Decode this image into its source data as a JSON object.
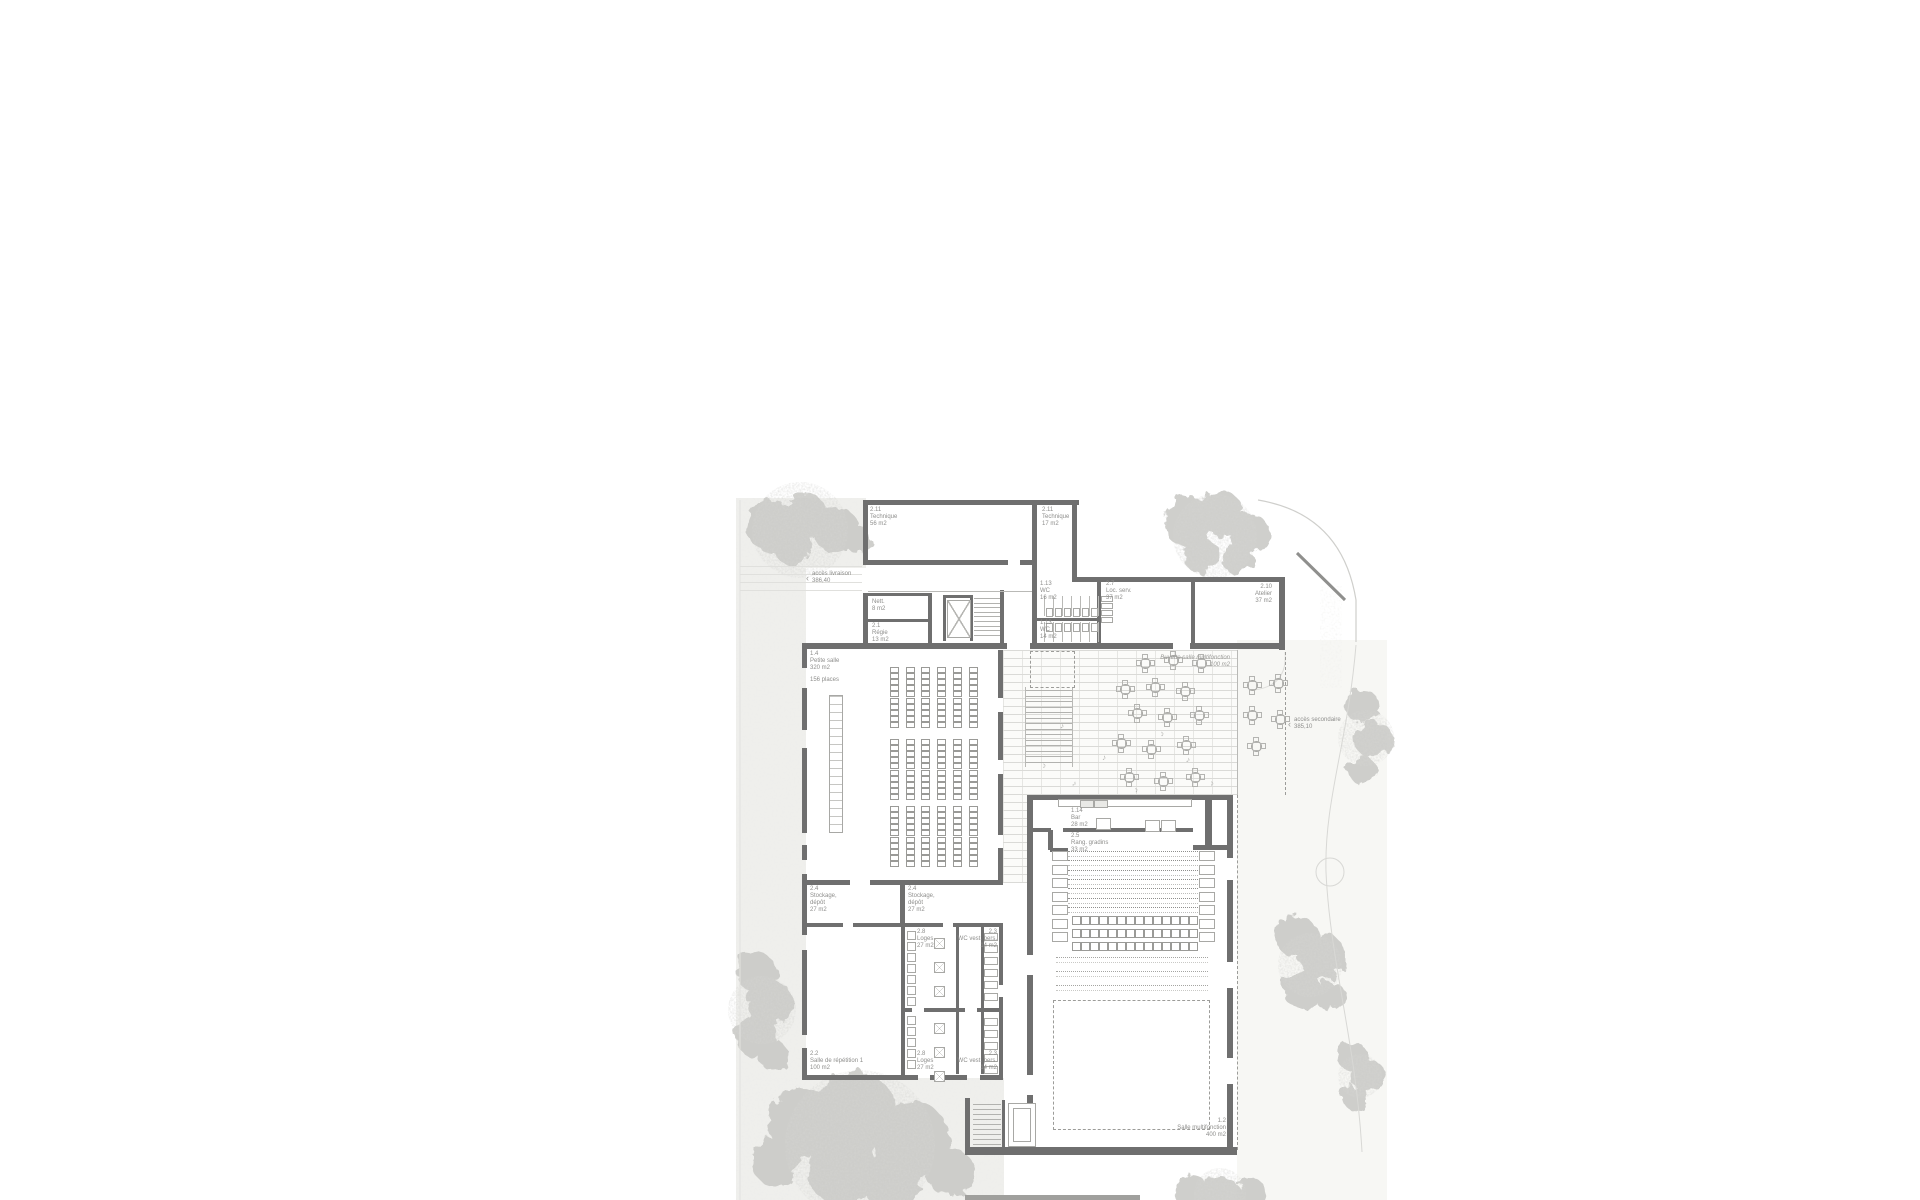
{
  "plan_title": "Rez-de-chaussée — salle multifonction",
  "rooms": {
    "technique_large": {
      "num": "2.11",
      "name": "Technique",
      "area": "56 m2"
    },
    "technique_small": {
      "num": "2.11",
      "name": "Technique",
      "area": "17 m2"
    },
    "wc_upper": {
      "num": "1.13",
      "name": "WC",
      "area": "16 m2"
    },
    "wc_lower": {
      "num": "1.13",
      "name": "WC",
      "area": "14 m2"
    },
    "loc_serv": {
      "num": "2.7",
      "name": "Loc. serv.",
      "area": "37 m2"
    },
    "atelier": {
      "num": "2.10",
      "name": "Atelier",
      "area": "37 m2"
    },
    "nett": {
      "name": "Nett.",
      "area": "8 m2"
    },
    "regie": {
      "num": "2.1",
      "name": "Régie",
      "area": "13 m2"
    },
    "petite_salle": {
      "num": "1.4",
      "name": "Petite salle",
      "area": "320 m2",
      "capacity": "156 places"
    },
    "buvette": {
      "name": "Buvette salle multifonction",
      "area": "100 m2"
    },
    "bar": {
      "num": "1.14",
      "name": "Bar",
      "area": "28 m2"
    },
    "rang_gradins": {
      "num": "2.5",
      "name": "Rang. gradins",
      "area": "33 m2"
    },
    "stockage_a": {
      "num": "2.4",
      "name": "Stockage,",
      "name2": "dépôt",
      "area": "27 m2"
    },
    "stockage_b": {
      "num": "2.4",
      "name": "Stockage,",
      "name2": "dépôt",
      "area": "27 m2"
    },
    "loges_a": {
      "num": "2.8",
      "name": "Loges",
      "area": "27 m2"
    },
    "wc_vest_a": {
      "num": "2.3",
      "name": "WC vest. pers.",
      "area": "14 m2"
    },
    "loges_b": {
      "num": "2.8",
      "name": "Loges",
      "area": "27 m2"
    },
    "wc_vest_b": {
      "num": "2.3",
      "name": "WC vest. pers.",
      "area": "14 m2"
    },
    "repetition": {
      "num": "2.2",
      "name": "Salle de répétition 1",
      "area": "100 m2"
    },
    "multifonction": {
      "num": "1.2",
      "name": "Salle multifonction",
      "area": "400 m2"
    }
  },
  "annotations": {
    "acces_livraison": {
      "label": "accès livraison",
      "level": "386,40"
    },
    "acces_secondaire": {
      "label": "accès secondaire",
      "level": "385,10"
    }
  },
  "colors": {
    "wall": "#6f6f6f",
    "thin_line": "#b9b9b6",
    "label": "#8e8e8c",
    "tree": "#c7c7c4",
    "ground": "#efefec"
  }
}
